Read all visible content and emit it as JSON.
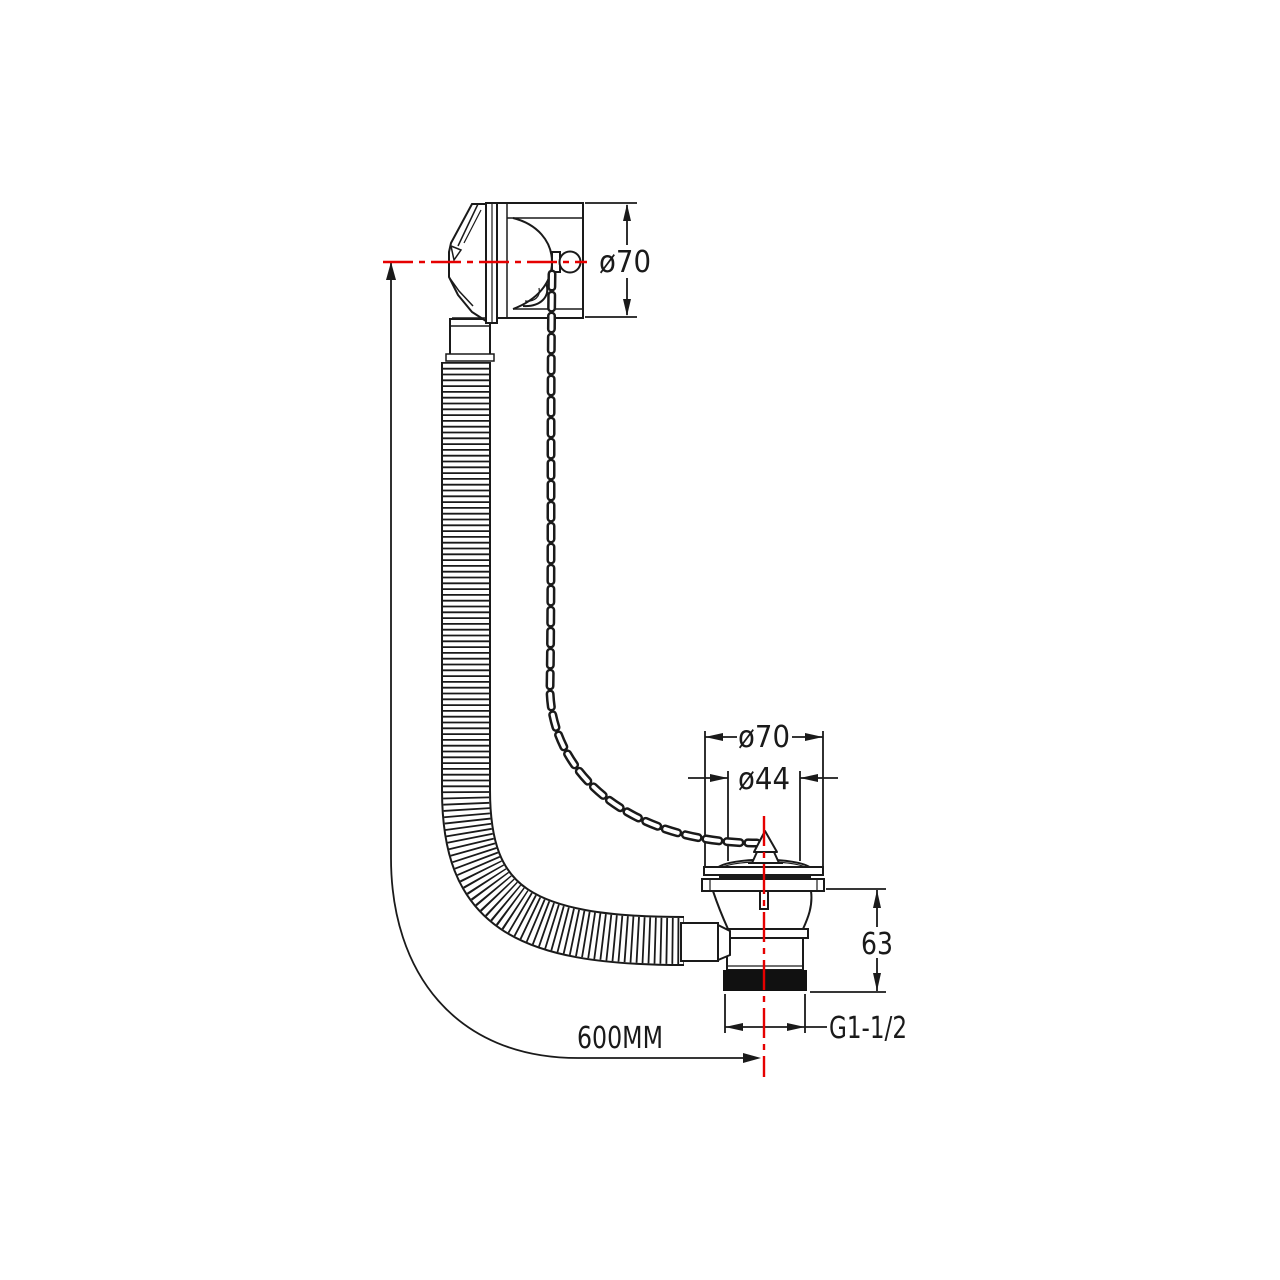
{
  "drawing": {
    "title": "bath-waste-and-overflow-technical-drawing",
    "colors": {
      "line": "#1a1a1a",
      "centerline": "#e60000",
      "background": "#ffffff",
      "thread_fill": "#111111"
    },
    "dimensions": {
      "overflow_diameter": "ø70",
      "waste_flange_diameter": "ø70",
      "waste_plug_diameter": "ø44",
      "waste_body_height": "63",
      "thread_size": "G1-1/2",
      "hose_length": "600MM"
    }
  }
}
